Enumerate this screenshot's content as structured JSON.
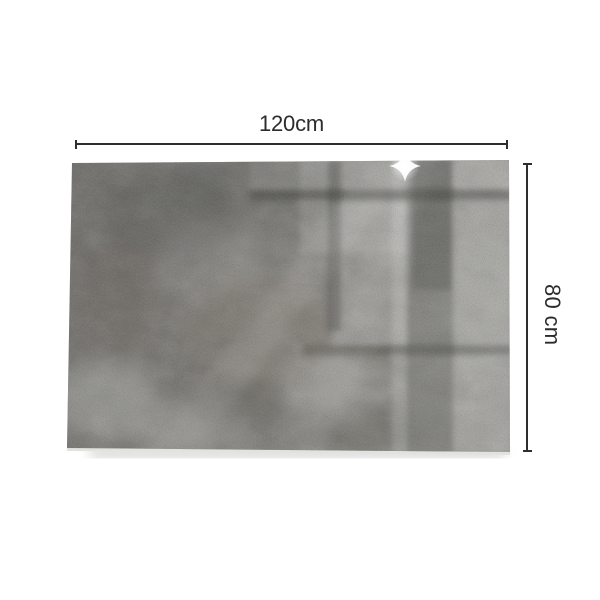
{
  "canvas": {
    "background_color": "#ffffff"
  },
  "annotations": {
    "width": {
      "label": "120cm"
    },
    "height": {
      "label": "80 cm"
    },
    "line_color": "#2e2e2e",
    "label_color": "#2c2c2c"
  },
  "panel": {
    "alt": "rectangular glass panel with gray concrete texture, window reflections and a sparkle highlight",
    "base_color": "#7d7c77",
    "light_area_color": "#969590",
    "dark_area_color": "#55544f",
    "reflection_frame_color": "#333330",
    "sparkle_color": "#ffffff",
    "shadow_color": "#8f8f8d"
  }
}
